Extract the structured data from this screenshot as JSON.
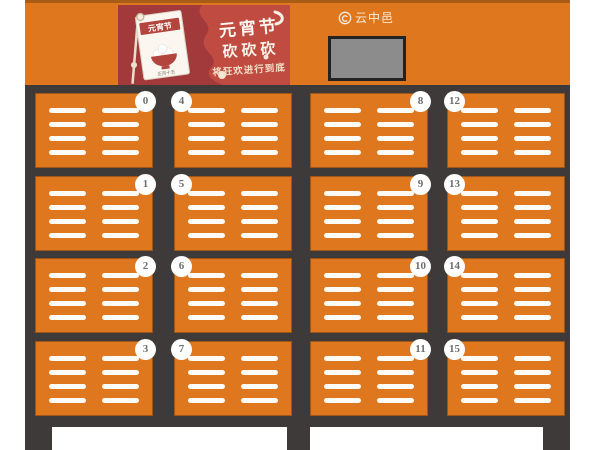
{
  "brand": {
    "name": "云中邑"
  },
  "header": {
    "banner": {
      "title": "元宵节",
      "slogan": "砍砍砍",
      "subtitle": "将狂欢进行到底",
      "calendar": {
        "label": "元宵节",
        "date_note": "正月十五"
      }
    }
  },
  "cabinet": {
    "columns": [
      {
        "badge_side": "right",
        "doors": [
          {
            "number": "0"
          },
          {
            "number": "1"
          },
          {
            "number": "2"
          },
          {
            "number": "3"
          }
        ]
      },
      {
        "badge_side": "left",
        "doors": [
          {
            "number": "4"
          },
          {
            "number": "5"
          },
          {
            "number": "6"
          },
          {
            "number": "7"
          }
        ]
      },
      {
        "badge_side": "right",
        "doors": [
          {
            "number": "8"
          },
          {
            "number": "9"
          },
          {
            "number": "10"
          },
          {
            "number": "11"
          }
        ]
      },
      {
        "badge_side": "left",
        "doors": [
          {
            "number": "12"
          },
          {
            "number": "13"
          },
          {
            "number": "14"
          },
          {
            "number": "15"
          }
        ]
      }
    ]
  },
  "colors": {
    "orange": "#DE771E",
    "orange-strip": "#A85C16",
    "frame": "#3E3A39",
    "banner-red": "#A23A3C",
    "banner-red-light": "#C04B41",
    "screen-gray": "#8C8C8C",
    "vent-white": "#FDFBF7",
    "badge-text": "#6E6E6E",
    "logo-cream": "#F6EDDC"
  }
}
